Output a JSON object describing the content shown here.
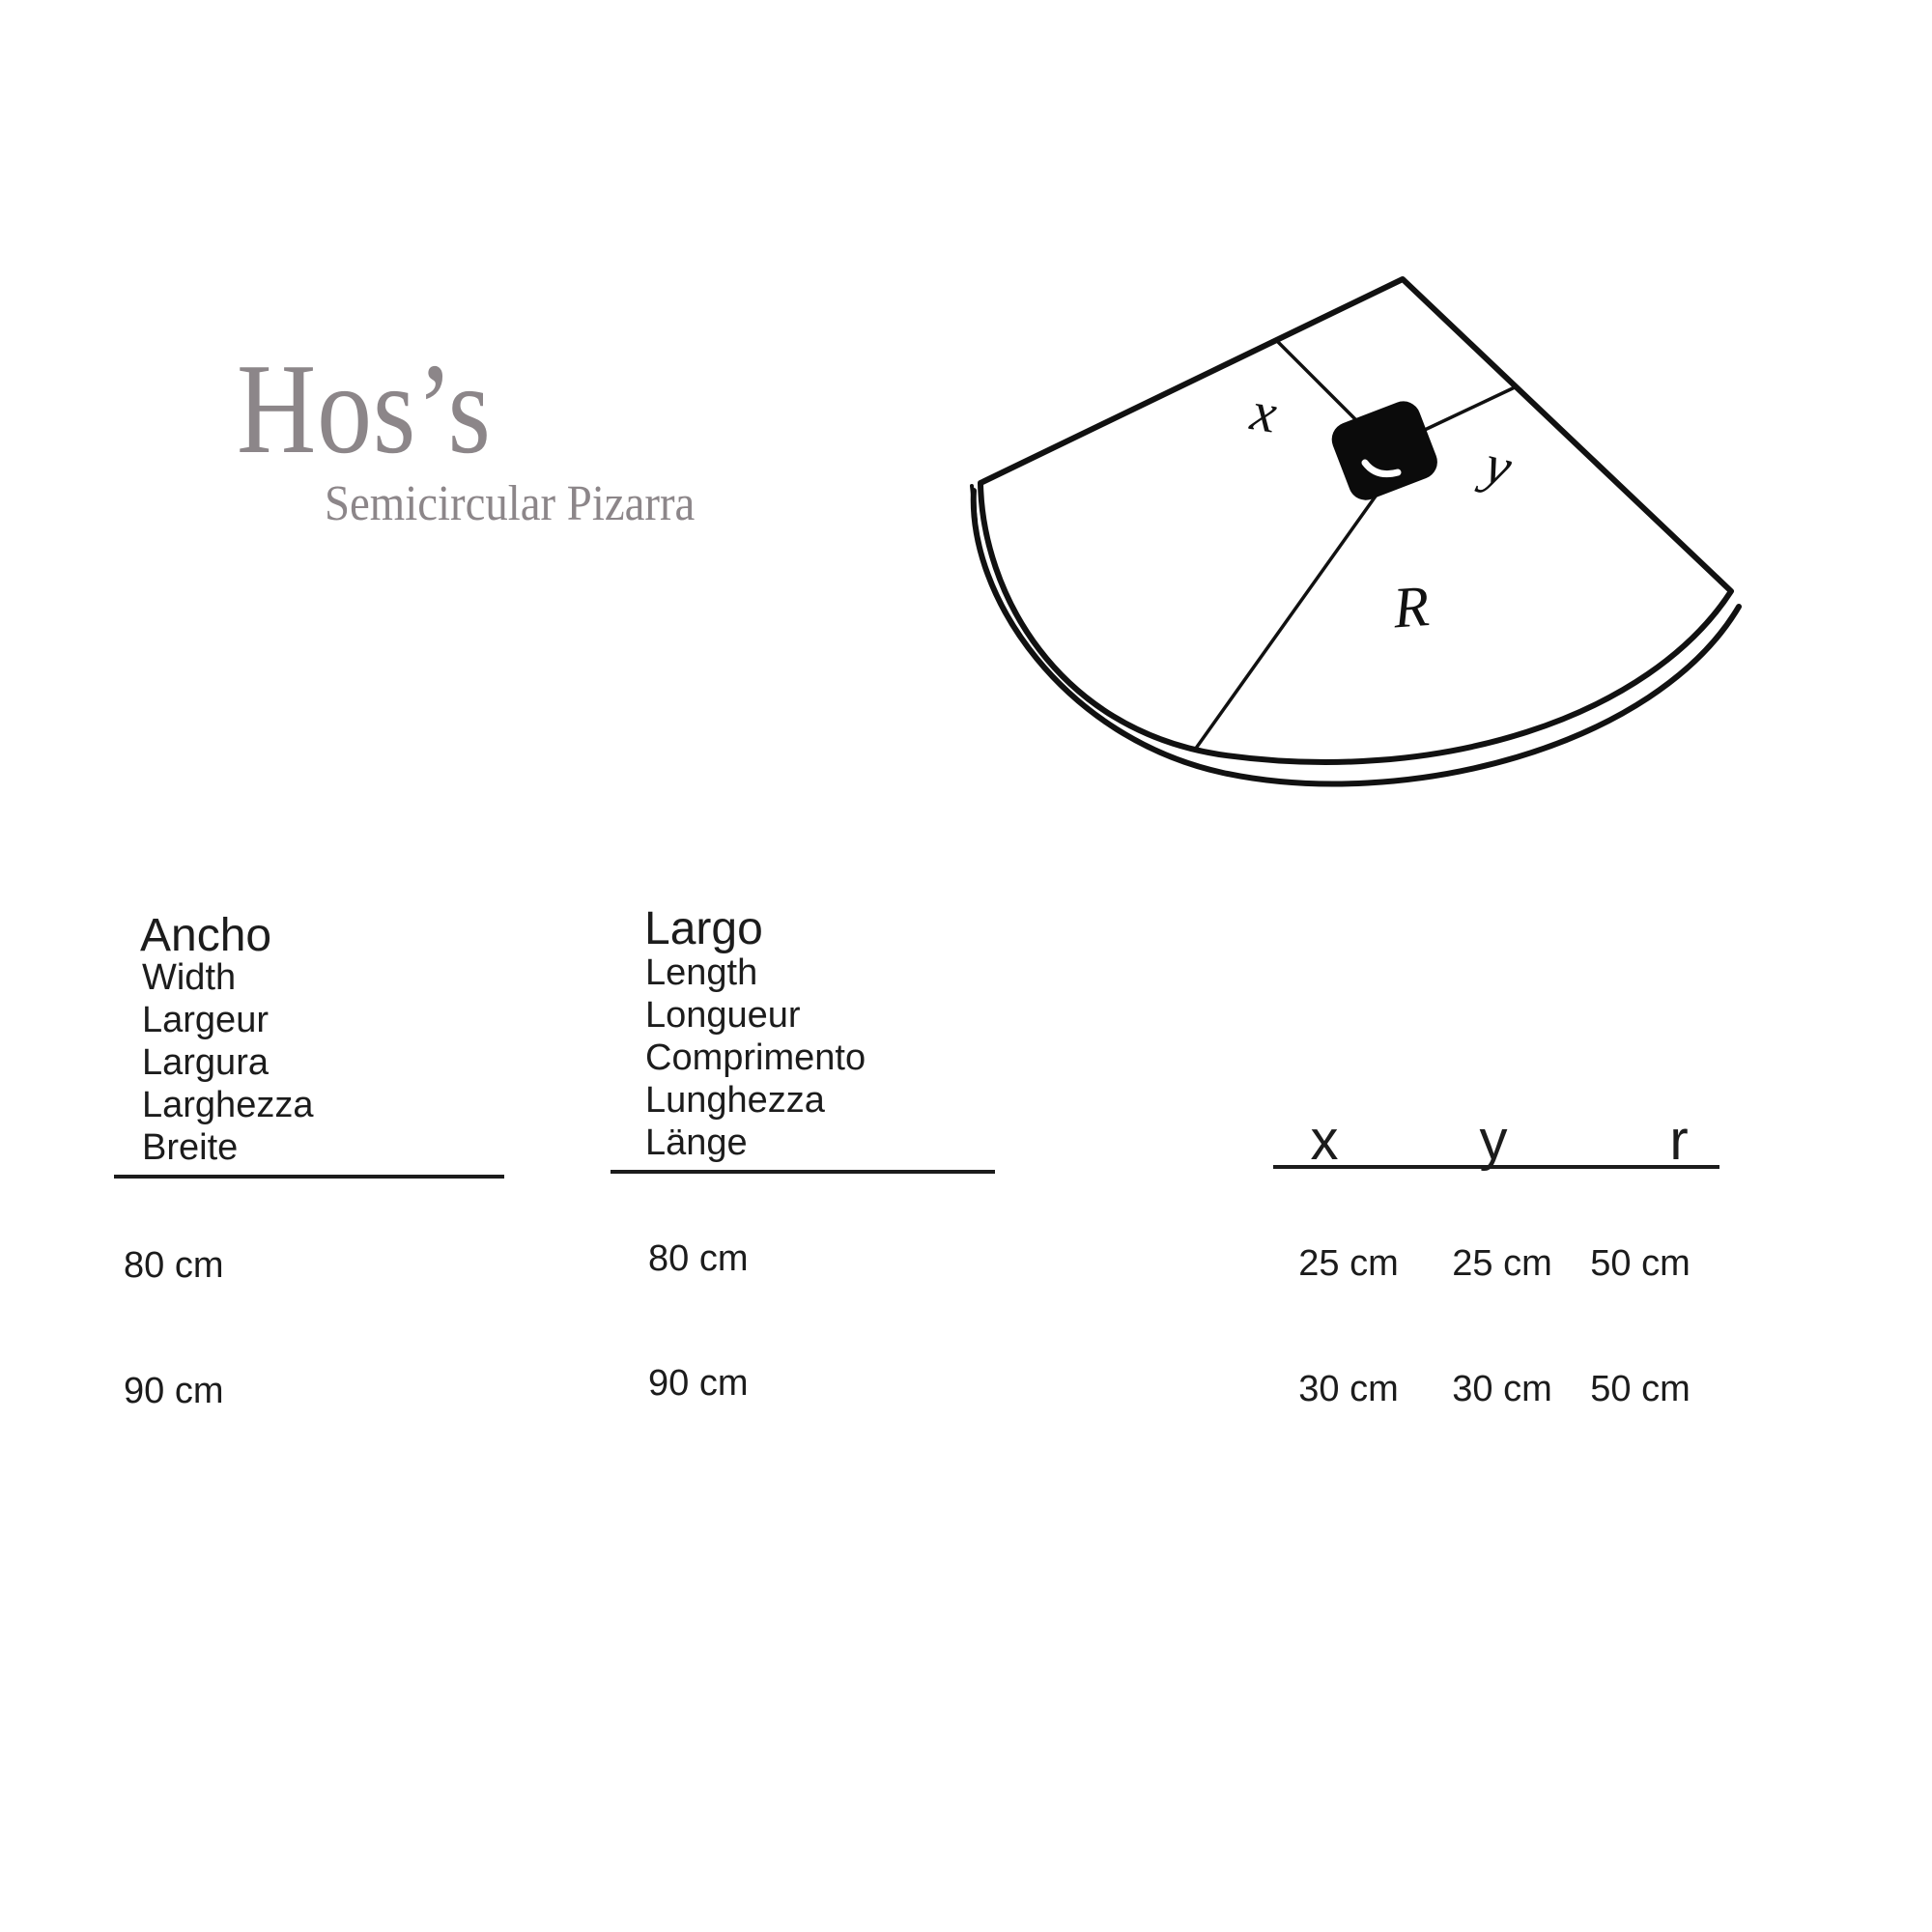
{
  "brand": {
    "title": "Hos’s",
    "subtitle": "Semicircular Pizarra"
  },
  "diagram": {
    "label_x": "x",
    "label_y": "y",
    "label_r": "R"
  },
  "table": {
    "width_col": {
      "header": "Ancho",
      "translations": [
        "Width",
        "Largeur",
        "Largura",
        "Larghezza",
        "Breite"
      ],
      "values": [
        "80 cm",
        "90 cm"
      ]
    },
    "length_col": {
      "header": "Largo",
      "translations": [
        "Length",
        "Longueur",
        "Comprimento",
        "Lunghezza",
        "Länge"
      ],
      "values": [
        "80 cm",
        "90 cm"
      ]
    },
    "xyr": {
      "headers": {
        "x": "x",
        "y": "y",
        "r": "r"
      },
      "rows": [
        {
          "x": "25 cm",
          "y": "25 cm",
          "r": "50 cm"
        },
        {
          "x": "30 cm",
          "y": "30 cm",
          "r": "50 cm"
        }
      ]
    }
  },
  "colors": {
    "brand_gray": "#8c8689",
    "ink": "#1c1c1c",
    "line": "#111111"
  }
}
